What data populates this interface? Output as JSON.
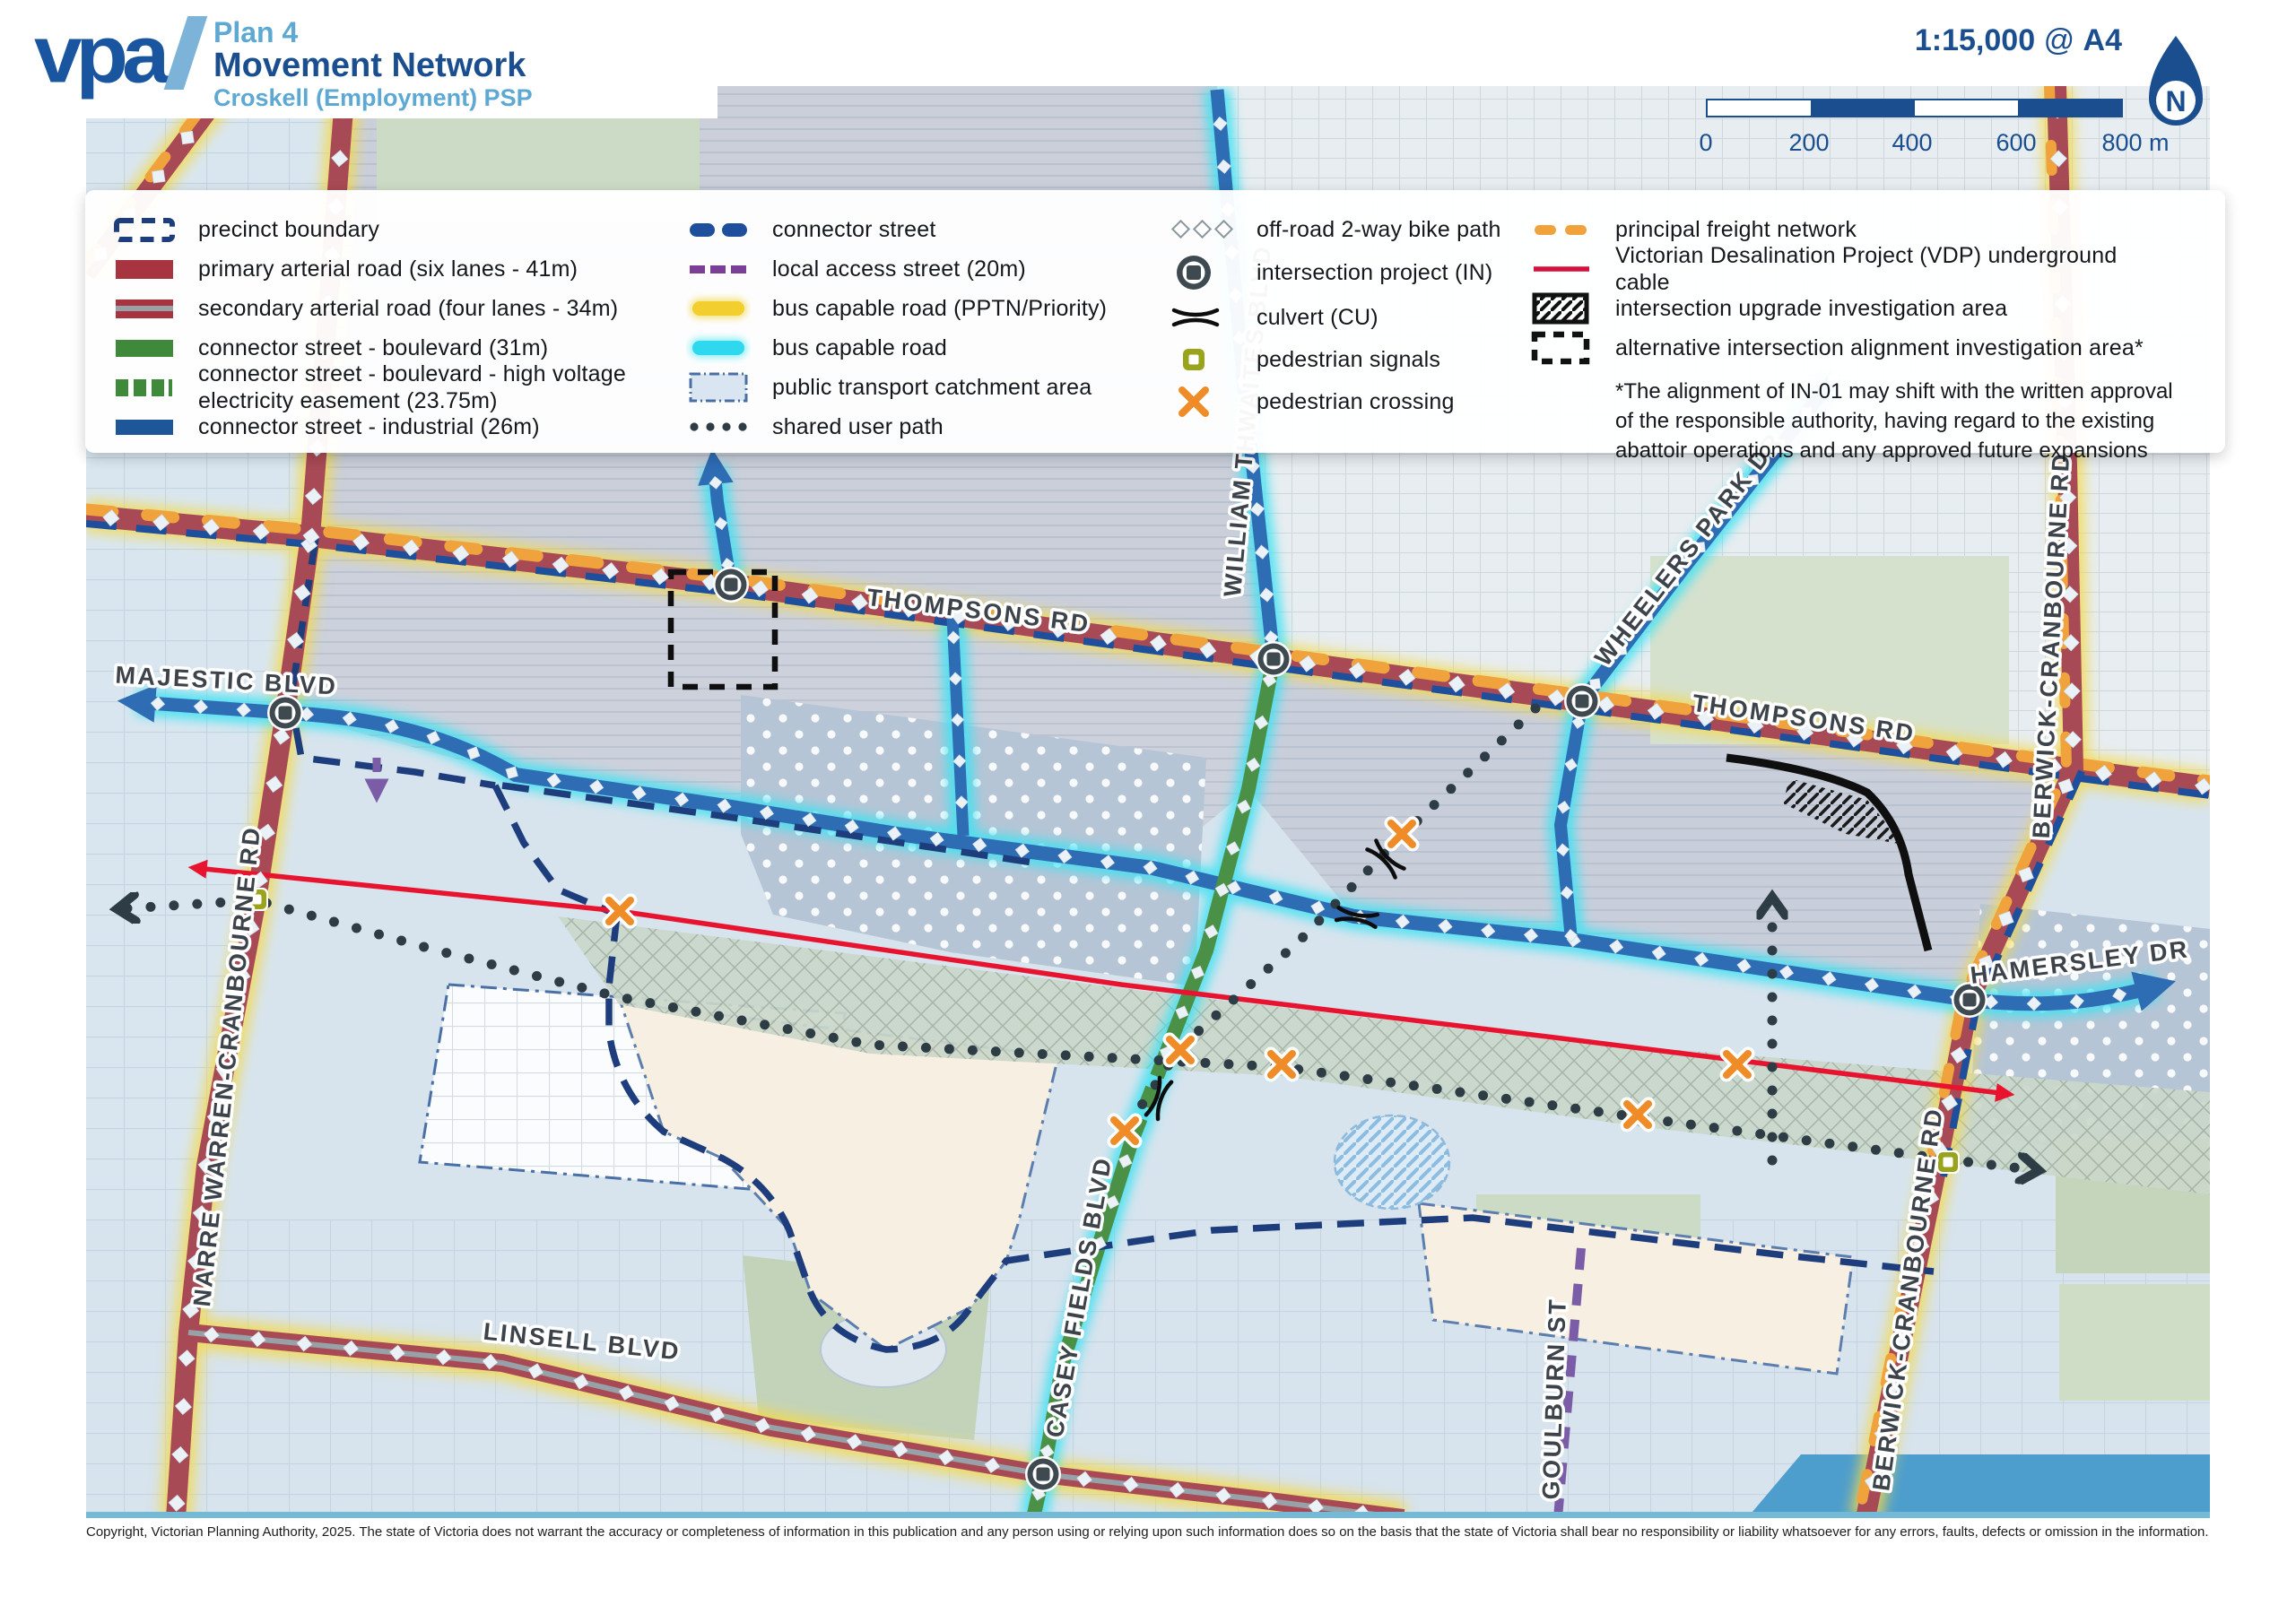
{
  "header": {
    "logo_text": "vpa",
    "plan_number": "Plan 4",
    "title": "Movement Network",
    "subtitle": "Croskell (Employment) PSP",
    "scale_ratio": "1:15,000",
    "scale_at": "@",
    "scale_page": "A4",
    "scale_ticks": [
      "0",
      "200",
      "400",
      "600",
      "800 m"
    ],
    "north_label": "N"
  },
  "legend": {
    "col1": [
      "precinct boundary",
      "primary arterial road (six lanes - 41m)",
      "secondary arterial road (four lanes - 34m)",
      "connector street - boulevard (31m)",
      "connector street - boulevard - high voltage electricity easement (23.75m)",
      "connector street - industrial (26m)"
    ],
    "col2": [
      "connector street",
      "local access street (20m)",
      "bus capable road (PPTN/Priority)",
      "bus capable road",
      "public transport catchment area",
      "shared user path"
    ],
    "col3": [
      "off-road 2-way bike path",
      "intersection project (IN)",
      "culvert (CU)",
      "pedestrian signals",
      "pedestrian crossing"
    ],
    "col4": [
      "principal freight network",
      "Victorian Desalination Project (VDP) underground cable",
      "intersection upgrade investigation area",
      "alternative intersection alignment investigation area*"
    ],
    "footnote": "*The alignment of IN-01 may shift with the written approval of the responsible authority, having regard to the existing abattoir operations and any approved future expansions"
  },
  "map": {
    "labels": [
      {
        "text": "MAJESTIC BLVD"
      },
      {
        "text": "THOMPSONS RD"
      },
      {
        "text": "THOMPSONS RD"
      },
      {
        "text": "WILLIAM THWAITES BLVD"
      },
      {
        "text": "WHEELERS PARK DR"
      },
      {
        "text": "BERWICK-CRANBOURNE RD"
      },
      {
        "text": "BERWICK-CRANBOURNE RD"
      },
      {
        "text": "HAMERSLEY DR"
      },
      {
        "text": "NARRE WARREN-CRANBOURNE RD"
      },
      {
        "text": "LINSELL BLVD"
      },
      {
        "text": "CASEY FIELDS BLVD"
      },
      {
        "text": "GOULBURN ST"
      }
    ]
  },
  "footer": {
    "copyright": "Copyright, Victorian Planning Authority, 2025. The state of Victoria does not warrant the accuracy or completeness of information in this publication and any person using or relying upon such information does so on the basis that the state of Victoria shall bear no responsibility or liability whatsoever for any errors, faults, defects or omission in the information."
  }
}
